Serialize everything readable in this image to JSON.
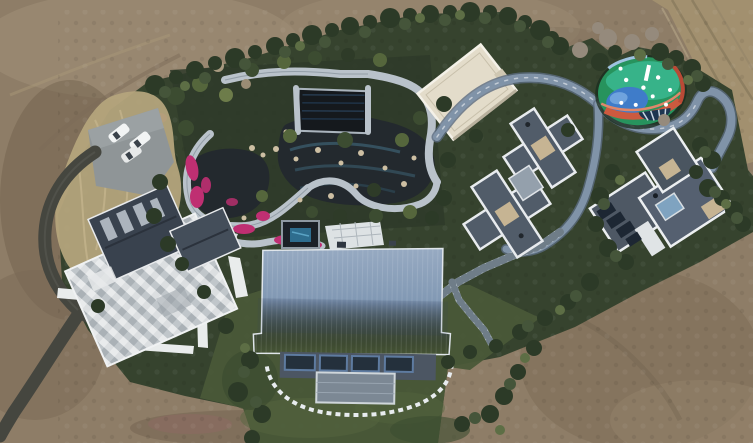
{
  "meta": {
    "type": "aerial-drone-photograph",
    "subject": "luxury estate compound with landscaped garden, surrounded by bare dirt ground",
    "width_px": 753,
    "height_px": 443
  },
  "palette": {
    "dirt": "#8e7d67",
    "dirt_light": "#a8977e",
    "dirt_dark": "#6f604d",
    "dirt_road": "#a2906f",
    "track_line": "#847456",
    "vegetation": "#36432e",
    "lawn": "#4a5838",
    "tree_dark": "#2c3a27",
    "tree_mid": "#45553a",
    "tree_light": "#5d6e45",
    "tree_bare": "#958a7c",
    "reeds": "#b4a47c",
    "asphalt": "#45463f",
    "parking": "#8f9597",
    "car_white": "#f2f4f4",
    "pond_water": "#23292e",
    "azalea_pink": "#bf2f72",
    "stone_path": "#b9c2ca",
    "patio_white": "#dde2e4",
    "pavilion_dark": "#15191d",
    "cream_roof": "#e3dcca",
    "slate_roof": "#515c69",
    "roof_trim": "#eceff1",
    "tan_skylight": "#c6b493",
    "blue_roof": "#7d92ad",
    "facade_dark": "#4c5663",
    "window_dark": "#24303c",
    "glass_blue": "#7fa3c0",
    "driveway_loop": "#8093a8",
    "playground_green": "#27935d",
    "playground_teal": "#37b389",
    "playground_blue": "#3f7cc9",
    "playground_red": "#cc5a3f",
    "playground_navy": "#1d3550",
    "spa_water": "#2e6d8e",
    "dark_wing": "#39424e"
  },
  "scene_objects": {
    "terrain": [
      "bare-dirt-field",
      "dirt-road-top-right",
      "estate-vegetation",
      "lawn",
      "tall-dry-reeds"
    ],
    "buildings": [
      "left-villa-mosaic-roof",
      "middle-villa-gray-cross-roof",
      "right-villa-gray-roof",
      "cream-flat-roof-pavilion",
      "large-blue-metal-roof-hall",
      "dark-garden-pavilion"
    ],
    "landscape": [
      "koi-pond-garden",
      "pink-azalea-beds",
      "stone-walkways",
      "spa-pool",
      "playground-multicolor",
      "stepping-stone-arc",
      "hedge-and-trees"
    ],
    "infrastructure": [
      "asphalt-driveway",
      "parking-pad",
      "white-cars",
      "curved-gray-loop-path",
      "stepped-walkway"
    ]
  },
  "vehicle_count": 3
}
